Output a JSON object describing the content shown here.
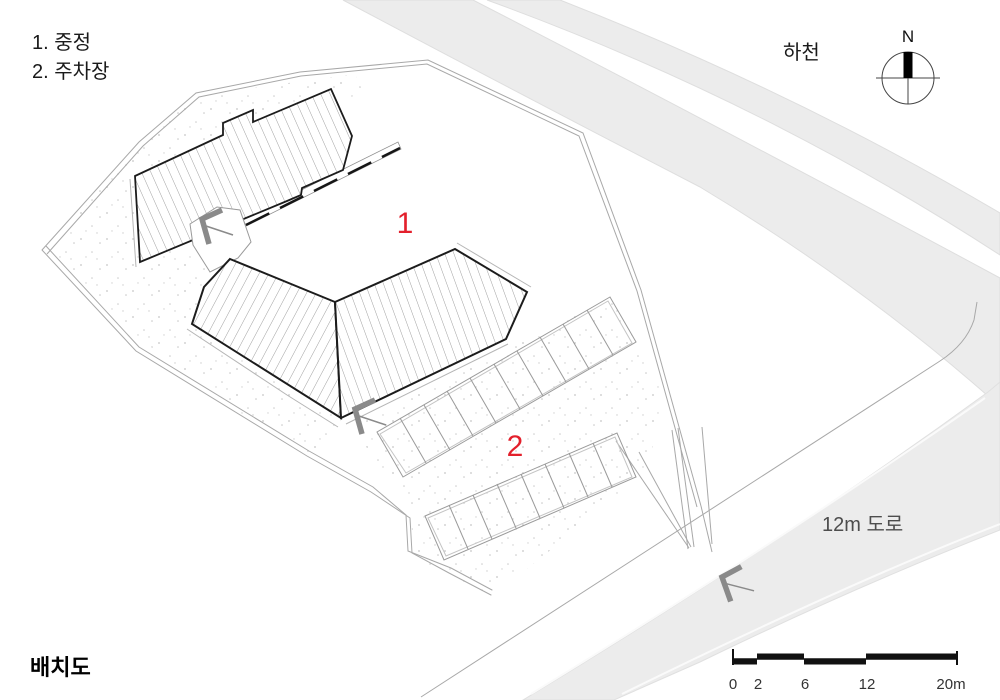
{
  "title": "배치도",
  "legend": {
    "item1": "1. 중정",
    "item2": "2. 주차장"
  },
  "labels": {
    "stream": "하천",
    "road": "12m 도로",
    "north": "N",
    "courtyard_number": "1",
    "parking_number": "2"
  },
  "scale_bar": {
    "ticks": [
      "0",
      "2",
      "6",
      "12",
      "20m"
    ]
  },
  "colors": {
    "accent_red": "#e3202c",
    "band_gray": "#ececec",
    "line_gray": "#a8a8a8",
    "outline_dark": "#1c1c1c"
  }
}
